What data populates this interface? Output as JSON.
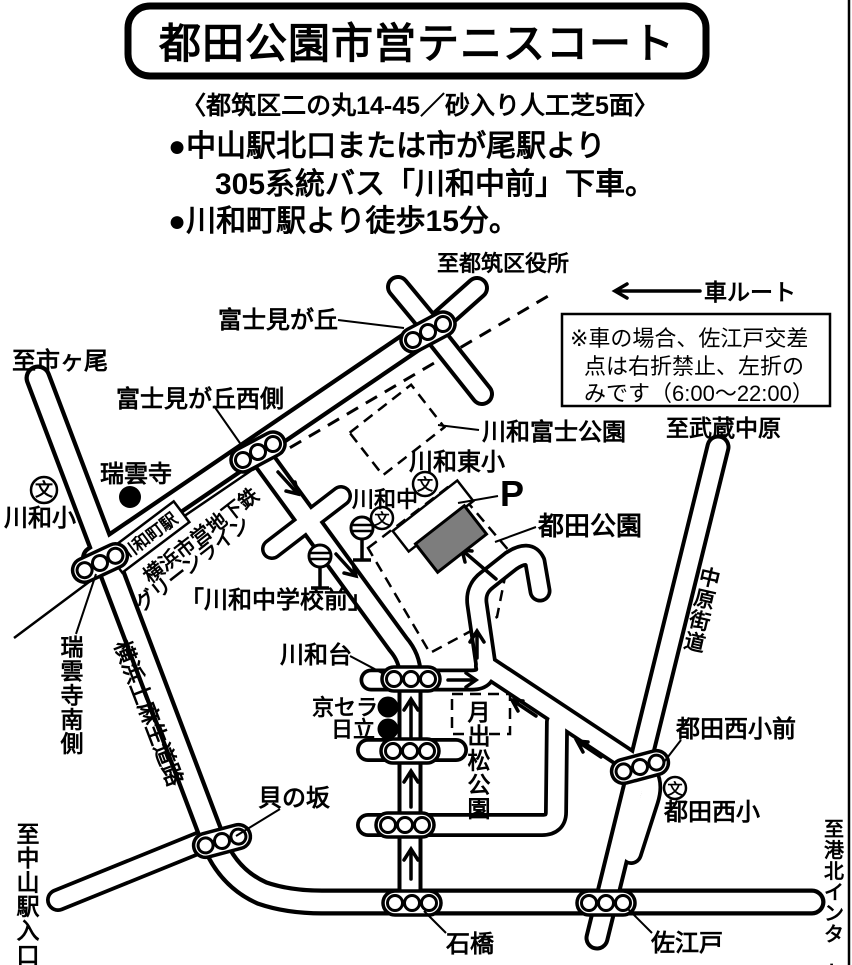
{
  "header": {
    "title": "都田公園市営テニスコート",
    "subtitle": "〈都筑区二の丸14-45／砂入り人工芝5面〉",
    "bullet1": "●中山駅北口または市が尾駅より",
    "bullet2": "305系統バス「川和中前」下車。",
    "bullet3": "●川和町駅より徒歩15分。"
  },
  "legend": {
    "car_route": "車ルート",
    "note1": "※車の場合、佐江戸交差",
    "note2": "点は右折禁止、左折の",
    "note3": "みです（6:00～22:00）"
  },
  "labels": {
    "to_tsuzuki_ward_office": "至都筑区役所",
    "fujimigaoka": "富士見が丘",
    "to_ichigao": "至市ヶ尾",
    "fujimigaoka_west": "富士見が丘西側",
    "kawawa_fuji_park": "川和富士公園",
    "to_musashi_nakahara": "至武蔵中原",
    "kawawa_higashi_elem": "川和東小",
    "kawawa_jhs": "川和中",
    "zuiunji": "瑞雲寺",
    "kawawa_elem": "川和小",
    "parking": "P",
    "tsuda_park": "都田公園",
    "kawawa_station": "川和町駅",
    "green_line_1": "横浜市営地下鉄",
    "green_line_2": "グリーンライン",
    "kawawa_jhs_mae_stop": "「川和中学校前」",
    "zuiunji_south": "瑞雲寺南側",
    "kamiasao_road": "横浜上麻生道路",
    "kawawadai": "川和台",
    "kyocera": "京セラ",
    "hitachi": "日立",
    "tsukidematsu_park": "月出松公園",
    "kainosaka": "貝の坂",
    "to_nakayama_sta_ent": "至中山駅入口",
    "ishibashi": "石橋",
    "saedo": "佐江戸",
    "to_kohoku_inter": "至港北インター",
    "tsuda_nishi_elem_mae": "都田西小前",
    "tsuda_nishi_elem": "都田西小",
    "nakahara_kaido": "中原街道",
    "school_symbol": "文"
  },
  "colors": {
    "ink": "#000000",
    "bg": "#ffffff",
    "court_fill": "#7d7d7d"
  }
}
